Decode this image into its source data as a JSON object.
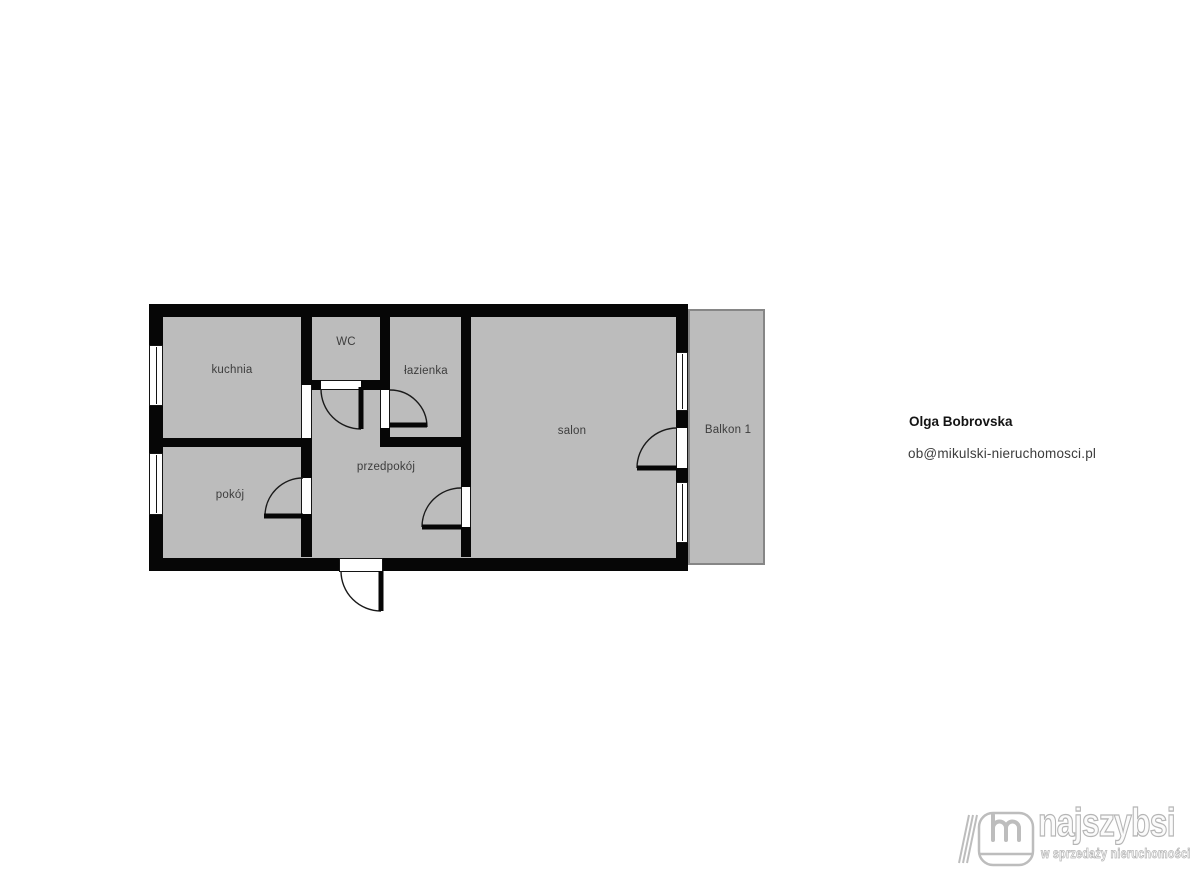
{
  "floorplan": {
    "rooms": [
      {
        "id": "kuchnia",
        "label": "kuchnia"
      },
      {
        "id": "wc",
        "label": "WC"
      },
      {
        "id": "lazienka",
        "label": "łazienka"
      },
      {
        "id": "pokoj",
        "label": "pokój"
      },
      {
        "id": "przedpokoj",
        "label": "przedpokój"
      },
      {
        "id": "salon",
        "label": "salon"
      },
      {
        "id": "balkon",
        "label": "Balkon 1"
      }
    ],
    "colors": {
      "wall": "#060606",
      "floor_fill": "#bcbcbc",
      "balcony_border": "#868686",
      "room_label": "#3d3d3d",
      "background": "#ffffff"
    }
  },
  "agent": {
    "name": "Olga Bobrovska",
    "email": "ob@mikulski-nieruchomosci.pl"
  },
  "logo": {
    "brand": "najszybsi",
    "tagline": "w sprzedaży nieruchomości",
    "color": "#b5b5b5"
  }
}
